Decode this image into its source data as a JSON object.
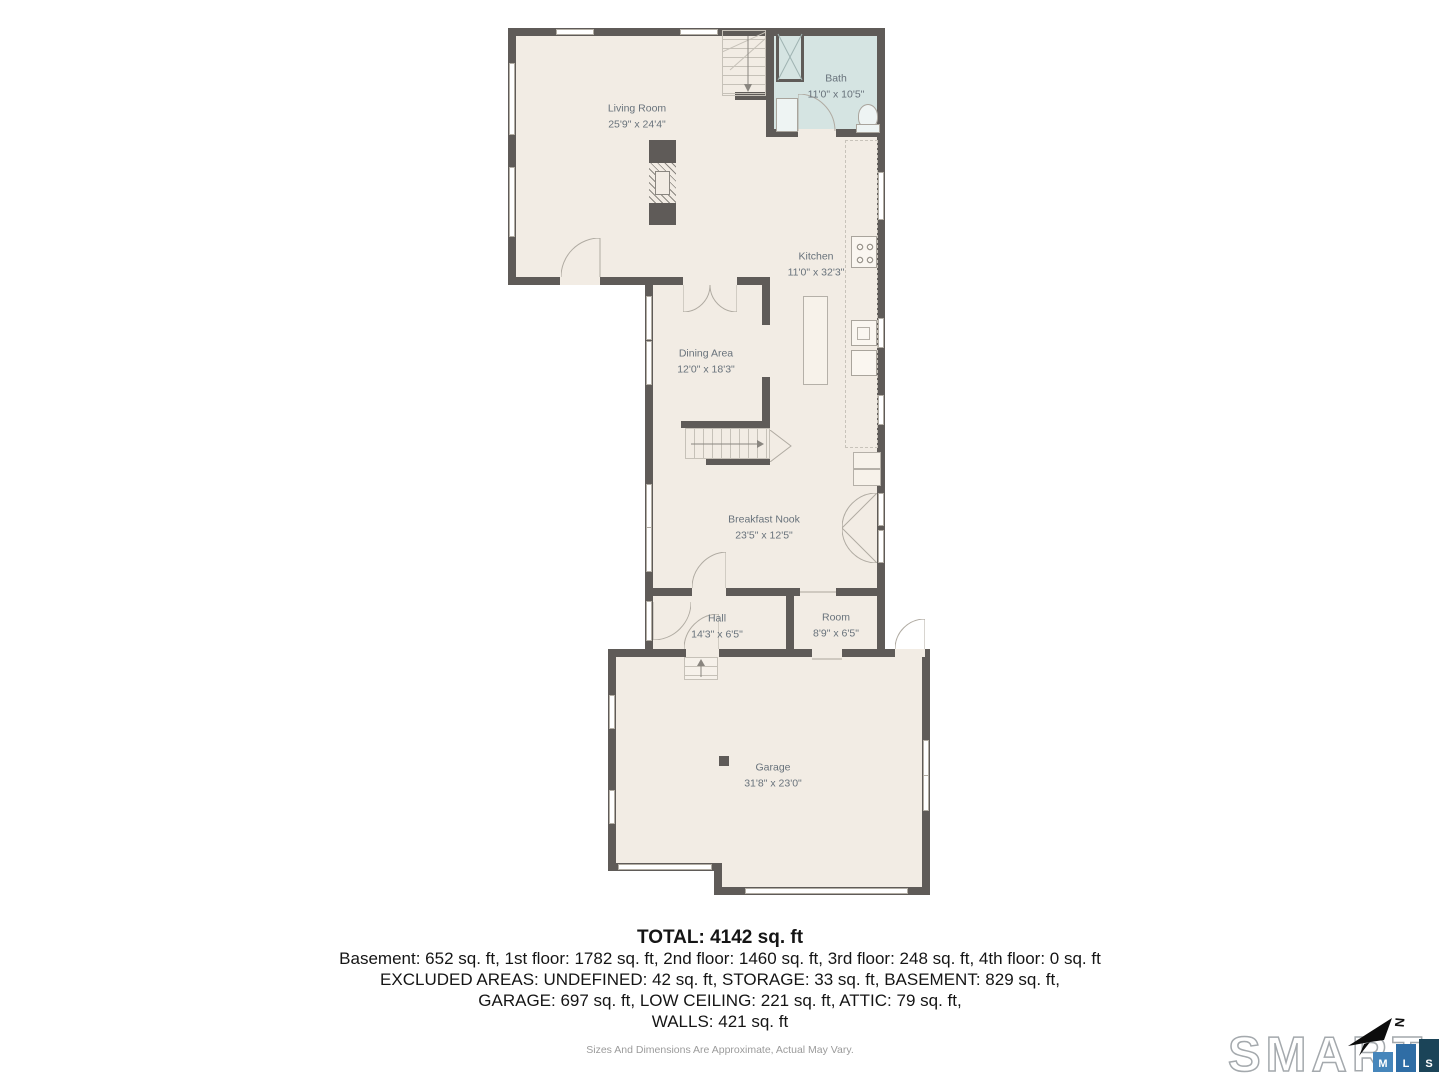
{
  "plan": {
    "rooms": [
      {
        "id": "living-room",
        "name": "Living Room",
        "dims": "25'9\" x 24'4\""
      },
      {
        "id": "bath",
        "name": "Bath",
        "dims": "11'0\" x 10'5\""
      },
      {
        "id": "kitchen",
        "name": "Kitchen",
        "dims": "11'0\" x 32'3\""
      },
      {
        "id": "dining-area",
        "name": "Dining Area",
        "dims": "12'0\" x 18'3\""
      },
      {
        "id": "breakfast-nook",
        "name": "Breakfast Nook",
        "dims": "23'5\" x 12'5\""
      },
      {
        "id": "hall",
        "name": "Hall",
        "dims": "14'3\" x 6'5\""
      },
      {
        "id": "room",
        "name": "Room",
        "dims": "8'9\" x 6'5\""
      },
      {
        "id": "garage",
        "name": "Garage",
        "dims": "31'8\" x 23'0\""
      }
    ],
    "colors": {
      "wall": "#5f5b58",
      "floor": "#f2ece4",
      "bath_floor": "#d5e4e2",
      "label": "#68727b"
    }
  },
  "summary": {
    "total": "TOTAL: 4142 sq. ft",
    "floors": "Basement: 652 sq. ft, 1st floor: 1782 sq. ft, 2nd floor: 1460 sq. ft, 3rd floor: 248 sq. ft, 4th floor: 0 sq. ft",
    "excluded1": "EXCLUDED AREAS: UNDEFINED: 42 sq. ft, STORAGE: 33 sq. ft, BASEMENT: 829 sq. ft,",
    "excluded2": "GARAGE: 697 sq. ft, LOW CEILING: 221 sq. ft, ATTIC: 79 sq. ft,",
    "walls": "WALLS: 421 sq. ft"
  },
  "disclaimer": "Sizes And Dimensions Are Approximate, Actual May Vary.",
  "branding": {
    "wordmark": "SMART",
    "squares": [
      {
        "letter": "M",
        "color": "#4686bb"
      },
      {
        "letter": "L",
        "color": "#2f6da5"
      },
      {
        "letter": "S",
        "color": "#1b4458"
      }
    ],
    "north_label": "N"
  }
}
